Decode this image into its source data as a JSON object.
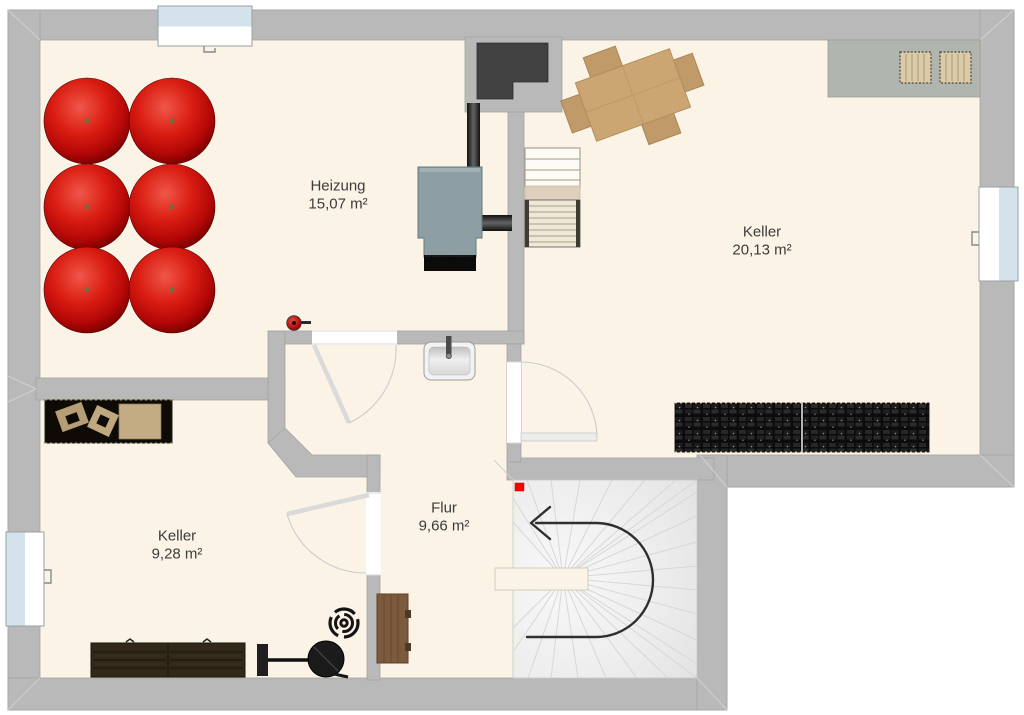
{
  "plan": {
    "type": "basement-floorplan",
    "rooms": [
      {
        "name": "Heizung",
        "area": "15,07 m²"
      },
      {
        "name": "Keller",
        "area": "20,13 m²"
      },
      {
        "name": "Keller",
        "area": "9,28 m²"
      },
      {
        "name": "Flur",
        "area": "9,66 m²"
      }
    ],
    "colors": {
      "floor": "#faf3e6",
      "wall": "#b9b9b9",
      "outside": "#ffffff",
      "tank_red": "#d41414",
      "boiler_gray_blue": "#8d9ea4",
      "chimney_dark": "#414141",
      "window_glass": "#d4e3eb",
      "marker_red": "#ff0000",
      "stair_tread": "#ededed",
      "wood_table": "#cba672",
      "wood_shelf": "#7b5a3d",
      "dark_storage": "#141414"
    },
    "legend": {
      "oil-tank": "round red heating-oil tank (6x)",
      "boiler": "central heating boiler with chimney pipe",
      "sink": "wall-mounted wash basin",
      "fire-extinguisher": "wall fire extinguisher",
      "winder-stairs": "U-shaped winder staircase with direction arrow",
      "upper-stairs": "straight stair flight to ground floor",
      "storage-shelves": "dark storage shelving units",
      "dining-table": "rotated wooden table with four chairs",
      "baskets": "two woven storage baskets on platform"
    }
  }
}
